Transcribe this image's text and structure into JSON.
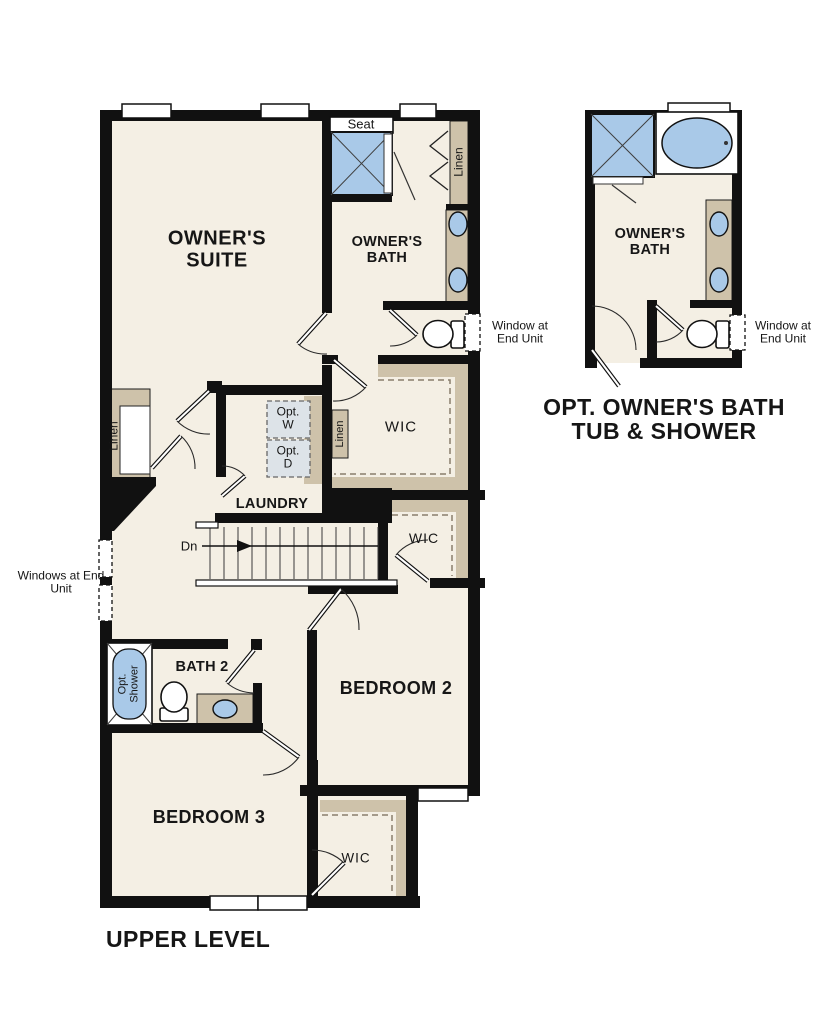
{
  "plan": {
    "level_label": "UPPER LEVEL",
    "owners_suite": "OWNER'S SUITE",
    "owners_bath": "OWNER'S BATH",
    "laundry": "LAUNDRY",
    "bath2": "BATH 2",
    "bedroom2": "BEDROOM 2",
    "bedroom3": "BEDROOM 3",
    "wic": "WIC",
    "linen": "Linen",
    "seat": "Seat",
    "down": "Dn",
    "opt_washer": "Opt. W",
    "opt_dryer": "Opt. D",
    "opt_shower": "Opt. Shower",
    "window_at_end_unit": "Window at End Unit",
    "windows_at_end_unit": "Windows at End Unit"
  },
  "optional_plan": {
    "owners_bath": "OWNER'S BATH",
    "window_at_end_unit": "Window at End Unit",
    "caption_line1": "OPT. OWNER'S BATH",
    "caption_line2": "TUB & SHOWER"
  },
  "colors": {
    "c_floor": "#f4efe4",
    "c_wall": "#111111",
    "c_casework": "#cec2aa",
    "c_fixture": "#a9c9e8",
    "c_appliance": "#dde3e8",
    "c_dash": "#8a7f6c"
  }
}
